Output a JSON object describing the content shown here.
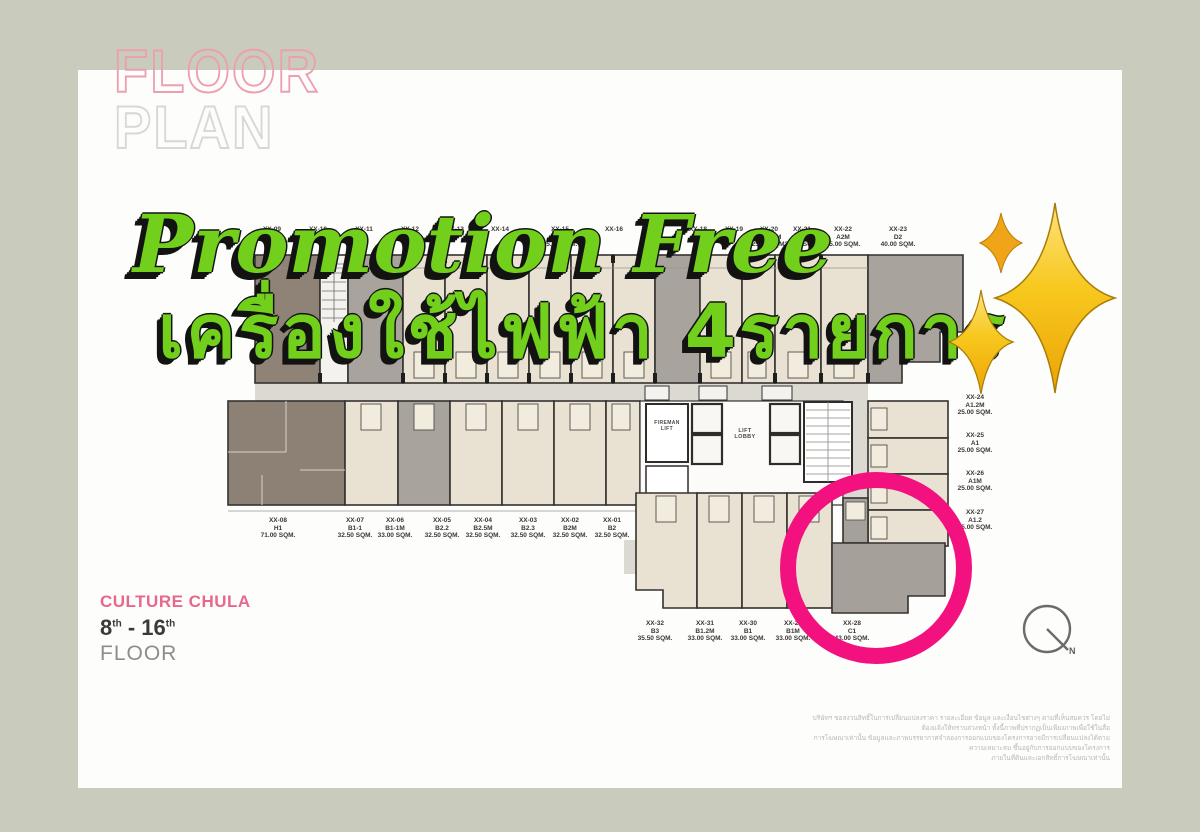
{
  "page": {
    "border_color": "#c9cbbc",
    "card_color": "#fdfdfc"
  },
  "header": {
    "floor_word": "FLOOR",
    "plan_word": "PLAN"
  },
  "promo": {
    "line1": "Promotion Free",
    "line2": "เครื่องใช้ไฟฟ้า 4รายการ",
    "text_color": "#72d01d",
    "sparkle_color": "#f5b916"
  },
  "project": {
    "name": "CULTURE CHULA",
    "floor_from": "8",
    "floor_from_sup": "th",
    "floor_to": " - 16",
    "floor_to_sup": "th",
    "floor_word": "FLOOR"
  },
  "compass": {
    "north_label": "N"
  },
  "plan": {
    "highlight_color": "#f2117f",
    "core": {
      "fireman_lift": "FIREMAN LIFT",
      "lift_lobby": "LIFT LOBBY"
    },
    "top_row": [
      {
        "code": "XX-09",
        "x": 272
      },
      {
        "code": "XX-10",
        "x": 318
      },
      {
        "code": "XX-11",
        "x": 364
      },
      {
        "code": "XX-12",
        "x": 410
      },
      {
        "code": "XX-13",
        "x": 455
      },
      {
        "code": "XX-14",
        "x": 500
      },
      {
        "code": "XX-15",
        "type": "A1-1",
        "sqm": "25.00 SQM.",
        "x": 560
      },
      {
        "code": "XX-16",
        "x": 614
      },
      {
        "code": "XX-17",
        "x": 656
      },
      {
        "code": "XX-18",
        "x": 698
      },
      {
        "code": "XX-19",
        "x": 734
      },
      {
        "code": "XX-20",
        "type": "A1-1.2M",
        "sqm": "25.00 SQM.",
        "x": 769
      },
      {
        "code": "XX-21",
        "type": "A2",
        "sqm": "25.00 SQM.",
        "x": 802
      },
      {
        "code": "XX-22",
        "type": "A2M",
        "sqm": "25.00 SQM.",
        "x": 843
      },
      {
        "code": "XX-23",
        "type": "D2",
        "sqm": "40.00 SQM.",
        "x": 898
      }
    ],
    "right_col": [
      {
        "code": "XX-24",
        "type": "A1.2M",
        "sqm": "25.00 SQM.",
        "x": 975,
        "y": 394
      },
      {
        "code": "XX-25",
        "type": "A1",
        "sqm": "25.00 SQM.",
        "x": 975,
        "y": 432
      },
      {
        "code": "XX-26",
        "type": "A1M",
        "sqm": "25.00 SQM.",
        "x": 975,
        "y": 470
      },
      {
        "code": "XX-27",
        "type": "A1.2",
        "sqm": "25.00 SQM.",
        "x": 975,
        "y": 509
      }
    ],
    "bottom_left_row": [
      {
        "code": "XX-08",
        "type": "H1",
        "sqm": "71.00 SQM.",
        "x": 278,
        "y": 517
      },
      {
        "code": "XX-07",
        "type": "B1-1",
        "sqm": "32.50 SQM.",
        "x": 355,
        "y": 517
      },
      {
        "code": "XX-06",
        "type": "B1-1M",
        "sqm": "33.00 SQM.",
        "x": 395,
        "y": 517
      },
      {
        "code": "XX-05",
        "type": "B2.2",
        "sqm": "32.50 SQM.",
        "x": 442,
        "y": 517
      },
      {
        "code": "XX-04",
        "type": "B2.5M",
        "sqm": "32.50 SQM.",
        "x": 483,
        "y": 517
      },
      {
        "code": "XX-03",
        "type": "B2.3",
        "sqm": "32.50 SQM.",
        "x": 528,
        "y": 517
      },
      {
        "code": "XX-02",
        "type": "B2M",
        "sqm": "32.50 SQM.",
        "x": 570,
        "y": 517
      },
      {
        "code": "XX-01",
        "type": "B2",
        "sqm": "32.50 SQM.",
        "x": 612,
        "y": 517
      }
    ],
    "bottom_right_row": [
      {
        "code": "XX-32",
        "type": "B3",
        "sqm": "35.50 SQM.",
        "x": 655,
        "y": 620
      },
      {
        "code": "XX-31",
        "type": "B1.2M",
        "sqm": "33.00 SQM.",
        "x": 705,
        "y": 620
      },
      {
        "code": "XX-30",
        "type": "B1",
        "sqm": "33.00 SQM.",
        "x": 748,
        "y": 620
      },
      {
        "code": "XX-29",
        "type": "B1M",
        "sqm": "33.00 SQM.",
        "x": 793,
        "y": 620
      },
      {
        "code": "XX-28",
        "type": "C1",
        "sqm": "43.00 SQM.",
        "x": 852,
        "y": 620
      }
    ]
  },
  "disclaimer": {
    "line1": "บริษัทฯ ขอสงวนสิทธิ์ในการเปลี่ยนแปลงราคา รายละเอียด ข้อมูล และเงื่อนไขต่างๆ ตามที่เห็นสมควร โดยไม่ต้องแจ้งให้ทราบล่วงหน้า ทั้งนี้ภาพที่ปรากฏเป็นเพียงภาพเพื่อใช้ในสื่อ",
    "line2": "การโฆษณาเท่านั้น ข้อมูลและภาพบรรยากาศจำลองการออกแบบของโครงการอาจมีการเปลี่ยนแปลงได้ตามความเหมาะสม ขึ้นอยู่กับการออกแบบของโครงการ",
    "line3": "ภายในที่ดินและเอกสิทธิ์การโฆษณาเท่านั้น"
  }
}
